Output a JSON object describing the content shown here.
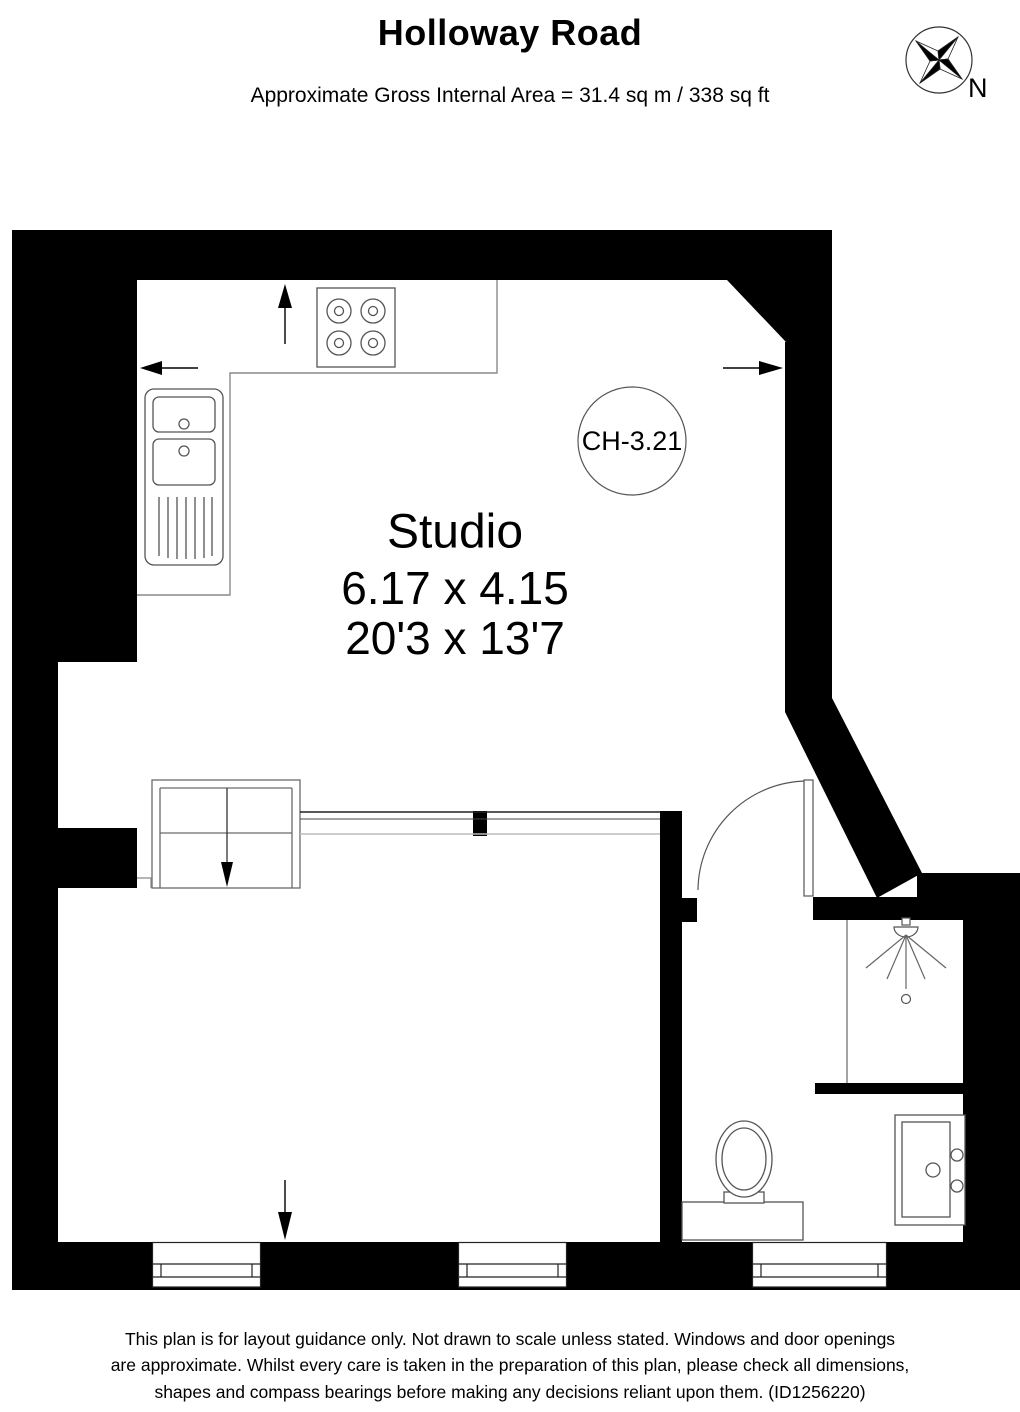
{
  "header": {
    "title": "Holloway Road",
    "subtitle": "Approximate Gross Internal Area = 31.4 sq m / 338 sq ft"
  },
  "compass": {
    "north_label": "N"
  },
  "plan": {
    "room_label": {
      "name": "Studio",
      "metric": "6.17 x 4.15",
      "imperial": "20'3 x 13'7"
    },
    "ceiling_height_label": "CH-3.21",
    "colors": {
      "wall": "#000000",
      "fixture_line": "#555555",
      "counter_line": "#8a8a8a",
      "light_line": "#bbbbbb"
    },
    "fixture_icons": [
      "hob-icon",
      "kitchen-sink-icon",
      "stairs-icon",
      "door-icon",
      "shower-icon",
      "toilet-icon",
      "washbasin-icon",
      "window-icon",
      "compass-icon",
      "opening-arrow-icon"
    ]
  },
  "footer": {
    "disclaimer": "This plan is for layout guidance only. Not drawn to scale unless stated. Windows and door openings are approximate. Whilst every care is taken in the preparation of this plan, please check all dimensions, shapes and compass bearings before making any decisions reliant upon them. (ID1256220)"
  }
}
